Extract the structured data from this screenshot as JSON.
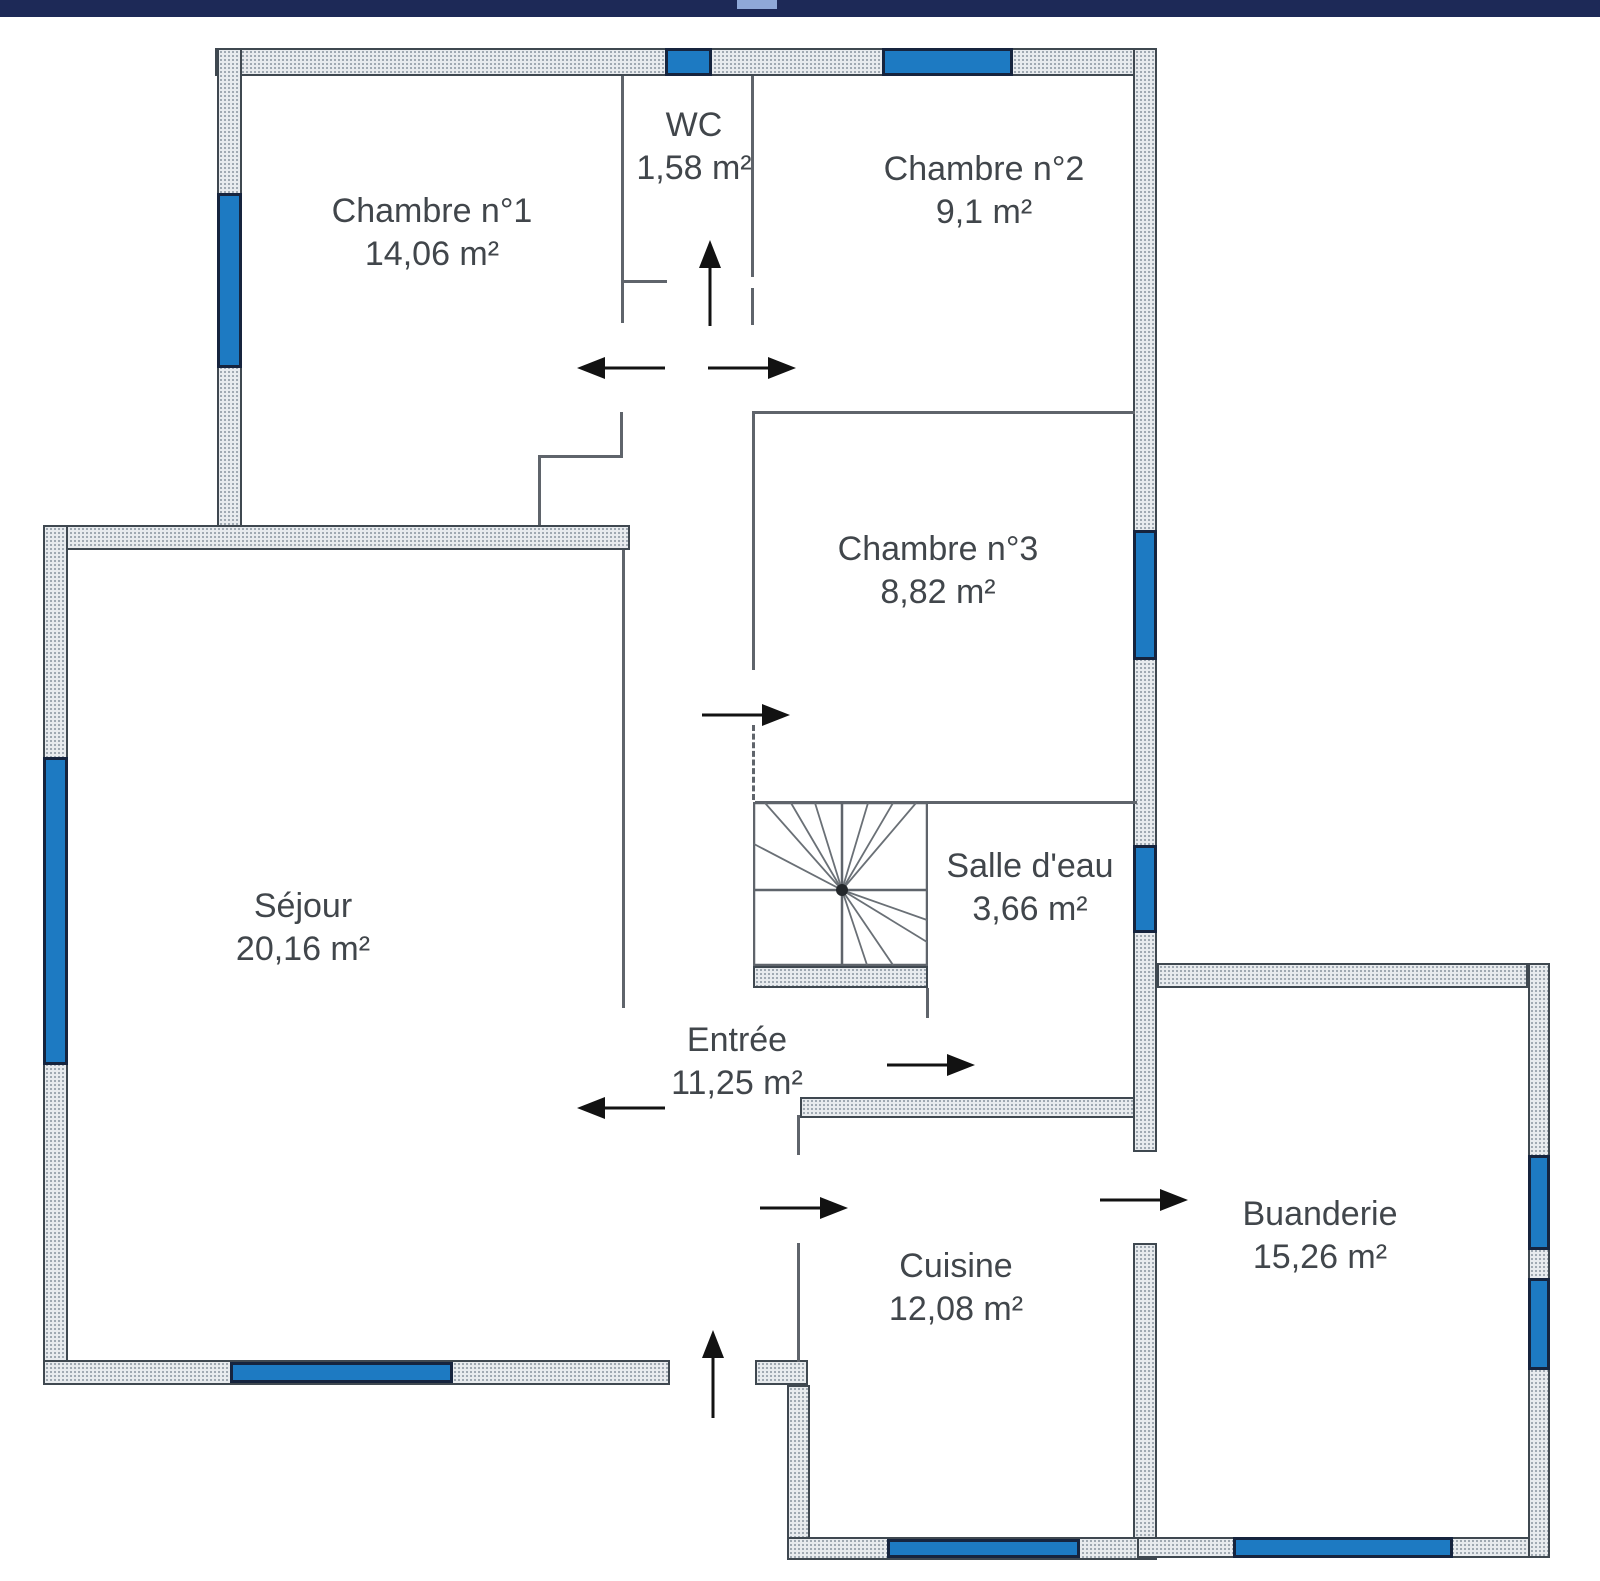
{
  "document": {
    "type": "floor-plan",
    "language": "fr",
    "total_rooms": 9
  },
  "rooms": {
    "chambre1": {
      "name": "Chambre n°1",
      "area": "14,06 m²"
    },
    "wc": {
      "name": "WC",
      "area": "1,58 m²"
    },
    "chambre2": {
      "name": "Chambre n°2",
      "area": "9,1 m²"
    },
    "chambre3": {
      "name": "Chambre n°3",
      "area": "8,82 m²"
    },
    "sejour": {
      "name": "Séjour",
      "area": "20,16 m²"
    },
    "salle_eau": {
      "name": "Salle d'eau",
      "area": "3,66 m²"
    },
    "entree": {
      "name": "Entrée",
      "area": "11,25 m²"
    },
    "cuisine": {
      "name": "Cuisine",
      "area": "12,08 m²"
    },
    "buanderie": {
      "name": "Buanderie",
      "area": "15,26 m²"
    }
  },
  "colors": {
    "header": "#1d2957",
    "header_notch": "#8fa8d8",
    "wall_fill": "#e8ebee",
    "wall_dot": "#9aa4ad",
    "wall_border": "#3f4850",
    "window_fill": "#1d7ac2",
    "window_border": "#16243e",
    "thin_wall": "#5f646b",
    "arrow": "#121212",
    "label": "#41464b"
  }
}
